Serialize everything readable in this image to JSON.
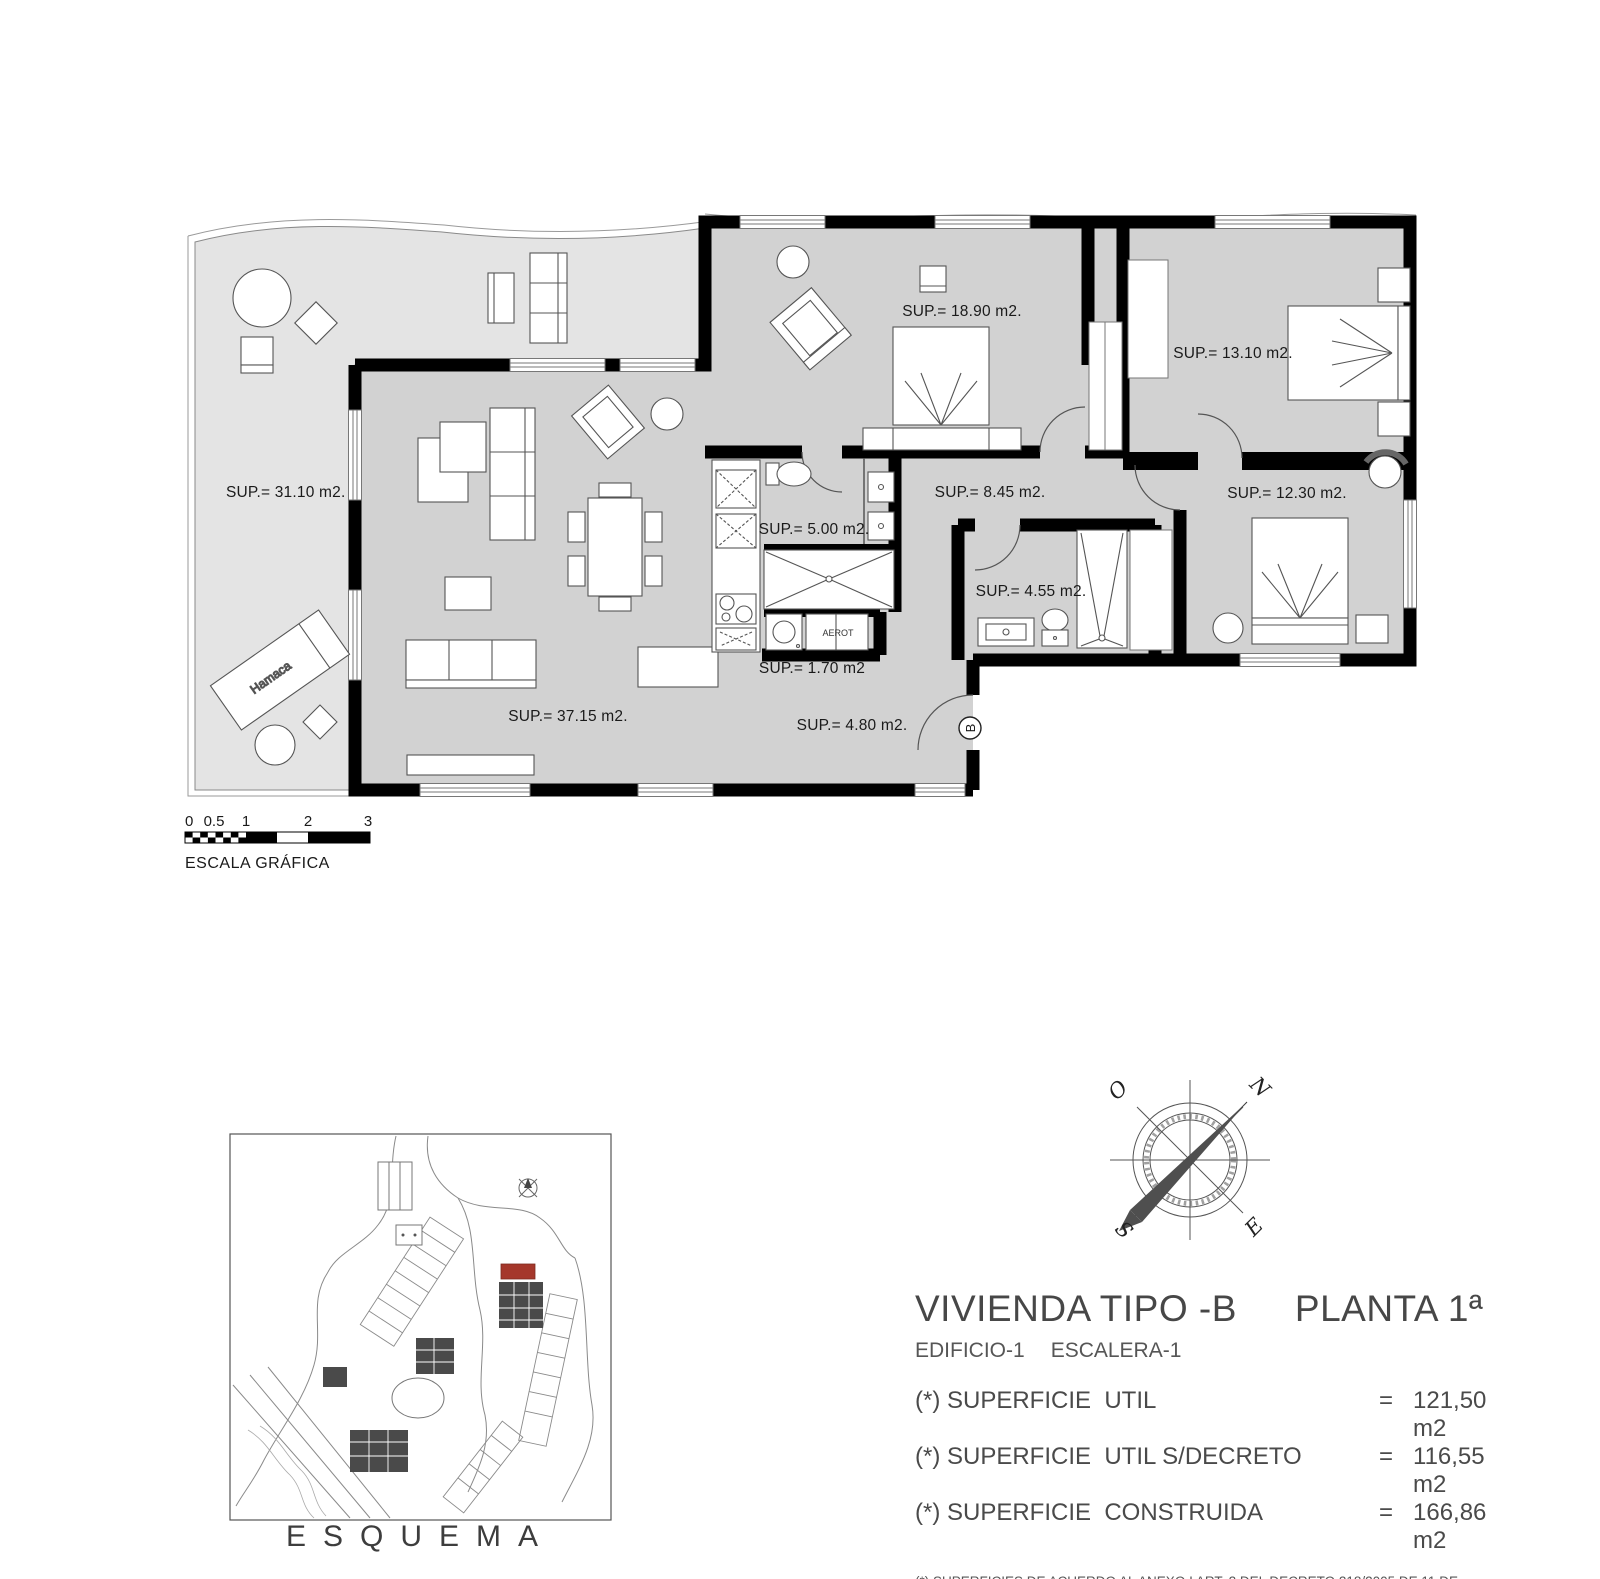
{
  "floor_plan": {
    "labels": {
      "terrace": "SUP.= 31.10 m2.",
      "living": "SUP.= 37.15 m2.",
      "bedroom1": "SUP.= 18.90 m2.",
      "bedroom2": "SUP.= 13.10 m2.",
      "bedroom3": "SUP.= 12.30 m2.",
      "hall": "SUP.= 8.45 m2.",
      "bathroom1": "SUP.= 5.00 m2.",
      "bathroom2": "SUP.= 4.55 m2.",
      "laundry": "SUP.= 1.70 m2",
      "entry": "SUP.= 4.80 m2."
    },
    "annotations": {
      "hamaca": "Hamaca",
      "aerot": "AEROT",
      "entrance_marker": "B"
    }
  },
  "scale_bar": {
    "ticks": [
      "0",
      "0.5",
      "1",
      "2",
      "3"
    ],
    "caption": "ESCALA GRÁFICA"
  },
  "compass": {
    "north": "N",
    "south": "S",
    "east": "E",
    "west": "O"
  },
  "site_plan": {
    "caption": "ESQUEMA",
    "highlight_color": "#a5372b"
  },
  "title_block": {
    "title": "VIVIENDA TIPO -B",
    "floor": "PLANTA 1ª",
    "building": "EDIFICIO-1",
    "stair": "ESCALERA-1",
    "areas": [
      {
        "label": "(*) SUPERFICIE  UTIL",
        "eq": "=",
        "value": "121,50 m2"
      },
      {
        "label": "(*) SUPERFICIE  UTIL S/DECRETO",
        "eq": "=",
        "value": "116,55 m2"
      },
      {
        "label": "(*) SUPERFICIE  CONSTRUIDA",
        "eq": "=",
        "value": "166,86 m2"
      }
    ],
    "footnote_line1": "(*) SUPERFICIES DE ACUERDO AL ANEXO I ART. 2 DEL DECRETO 218/2005 DE 11 DE OCTUBRE",
    "footnote_line2": "REGLAMENTO DE INFORMACION AL CONSUMIDOR."
  }
}
